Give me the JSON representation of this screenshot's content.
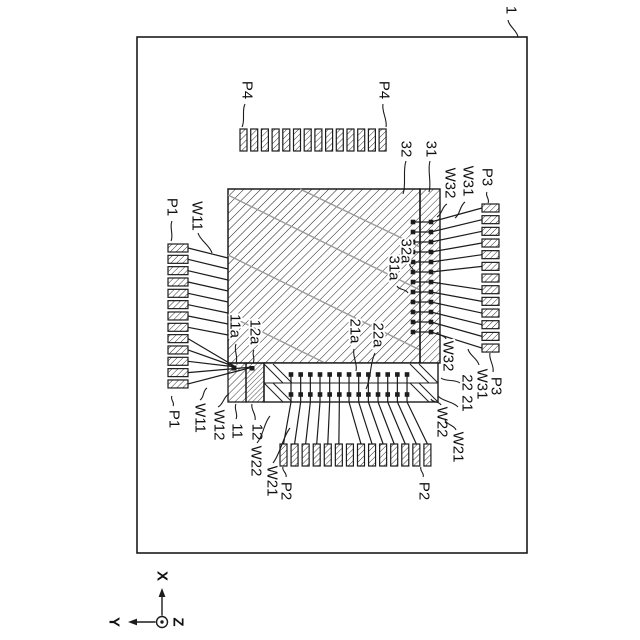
{
  "canvas": {
    "w": 640,
    "h": 640,
    "bg": "#ffffff"
  },
  "colors": {
    "line": "#1c1c1c",
    "gray": "#9b9b9b",
    "text": "#111111",
    "halo": "#ffffff"
  },
  "board": {
    "x": 137,
    "y": 37,
    "w": 390,
    "h": 516
  },
  "chip": {
    "x": 228,
    "y": 189,
    "w": 192,
    "h": 174,
    "gray_lines": [
      [
        228,
        195,
        420,
        290
      ],
      [
        228,
        255,
        420,
        350
      ],
      [
        228,
        315,
        325,
        363
      ],
      [
        300,
        189,
        420,
        247
      ]
    ]
  },
  "strip": {
    "x": 420,
    "y": 189,
    "w": 20,
    "h": 174
  },
  "bottom_strip": {
    "x": 228,
    "top": 363,
    "right": 438,
    "bottom": 402,
    "divider_y": 383,
    "cell11_x": 228,
    "cell12_x": 246,
    "cell_w": 18,
    "main_x": 264,
    "marks": [
      [
        234,
        366
      ],
      [
        252,
        366
      ]
    ],
    "decor": [
      [
        264,
        364,
        283,
        383
      ],
      [
        273,
        364,
        292,
        383
      ],
      [
        264,
        383,
        283,
        402
      ],
      [
        273,
        383,
        292,
        402
      ],
      [
        410,
        364,
        429,
        383
      ],
      [
        419,
        364,
        438,
        383
      ],
      [
        410,
        383,
        429,
        402
      ],
      [
        419,
        383,
        438,
        402
      ]
    ]
  },
  "pads": {
    "p4": {
      "count": 14,
      "x0": 240,
      "pitch": 10.7,
      "w": 7,
      "y": 129,
      "h": 22
    },
    "p1": {
      "count": 13,
      "y0": 244,
      "pitch": 11.33,
      "h": 8,
      "x": 168,
      "w": 20
    },
    "p3": {
      "count": 13,
      "y0": 204,
      "pitch": 11.67,
      "h": 8,
      "x": 482,
      "w": 17
    },
    "p2": {
      "count": 14,
      "x0": 280,
      "pitch": 11.07,
      "w": 7,
      "y": 444,
      "h": 22
    }
  },
  "dots": {
    "bottom": {
      "count": 13,
      "x0": 291,
      "pitch": 9.67,
      "row1": 374.5,
      "row2": 394.5,
      "size": 4.6,
      "strip_bottom": 402,
      "pad_top": 444,
      "pad_cx0": 283.5,
      "pad_pitch": 11.07,
      "skip_from": 6
    },
    "right": {
      "count": 12,
      "y0": 222,
      "pitch": 10,
      "col1": 413,
      "col2": 431,
      "size": 4.6,
      "pad_x": 482,
      "pad_cy0": 208,
      "pad_pitch": 11.67,
      "skip_from": 6
    }
  },
  "left_wires": {
    "pad_x": 188,
    "edge_x": 228,
    "edge_y0": 258,
    "edge_pitch": 11,
    "to_edge_count": 8,
    "cell11_target": [
      236,
      367
    ],
    "cell12_target": [
      253,
      367
    ],
    "cell11_wire_count": 3
  },
  "labels": [
    {
      "t": "1",
      "x": 511,
      "y": 10,
      "lead": [
        [
          508,
          20,
          518,
          37
        ]
      ]
    },
    {
      "t": "P4",
      "x": 247,
      "y": 90,
      "lead": [
        [
          245,
          104,
          242,
          127
        ]
      ]
    },
    {
      "t": "P4",
      "x": 384,
      "y": 90,
      "lead": [
        [
          383,
          104,
          386,
          127
        ]
      ]
    },
    {
      "t": "P1",
      "x": 172,
      "y": 207,
      "lead": [
        [
          172,
          221,
          171,
          241
        ]
      ]
    },
    {
      "t": "W11",
      "x": 197,
      "y": 216,
      "lead": [
        [
          198,
          233,
          212,
          253
        ]
      ]
    },
    {
      "t": "32",
      "x": 406,
      "y": 149,
      "lead": [
        [
          406,
          161,
          403,
          194
        ]
      ]
    },
    {
      "t": "31",
      "x": 431,
      "y": 149,
      "lead": [
        [
          430,
          161,
          429,
          192
        ]
      ]
    },
    {
      "t": "W32",
      "x": 450,
      "y": 183,
      "lead": [
        [
          447,
          204,
          437,
          217
        ]
      ]
    },
    {
      "t": "W31",
      "x": 468,
      "y": 181,
      "lead": [
        [
          465,
          202,
          455,
          218
        ]
      ]
    },
    {
      "t": "P3",
      "x": 487,
      "y": 177,
      "lead": [
        [
          487,
          192,
          488,
          203
        ]
      ]
    },
    {
      "t": "11a",
      "x": 235,
      "y": 326,
      "lead": [
        [
          236,
          344,
          236,
          363
        ]
      ]
    },
    {
      "t": "12a",
      "x": 255,
      "y": 332,
      "lead": [
        [
          254,
          350,
          253,
          363
        ]
      ]
    },
    {
      "t": "21a",
      "x": 355,
      "y": 331,
      "lead": [
        [
          354,
          349,
          356,
          371
        ]
      ]
    },
    {
      "t": "22a",
      "x": 378,
      "y": 335,
      "lead": [
        [
          375,
          353,
          366,
          389
        ]
      ]
    },
    {
      "t": "31a",
      "x": 394,
      "y": 268,
      "lead": [
        [
          397,
          286,
          408,
          293
        ]
      ]
    },
    {
      "t": "32a",
      "x": 406,
      "y": 251,
      "lead": [
        [
          410,
          264,
          413,
          271
        ]
      ]
    },
    {
      "t": "P1",
      "x": 174,
      "y": 419,
      "lead": [
        [
          173,
          406,
          172,
          396
        ]
      ]
    },
    {
      "t": "W11",
      "x": 200,
      "y": 418,
      "lead": [
        [
          200,
          400,
          207,
          388
        ]
      ]
    },
    {
      "t": "W12",
      "x": 219,
      "y": 425,
      "lead": [
        [
          218,
          407,
          229,
          394
        ]
      ]
    },
    {
      "t": "11",
      "x": 237,
      "y": 431,
      "lead": [
        [
          236,
          419,
          236,
          404
        ]
      ]
    },
    {
      "t": "12",
      "x": 257,
      "y": 432,
      "lead": [
        [
          255,
          420,
          252,
          404
        ]
      ]
    },
    {
      "t": "W22",
      "x": 256,
      "y": 461,
      "lead": [
        [
          257,
          443,
          270,
          416
        ]
      ]
    },
    {
      "t": "W21",
      "x": 272,
      "y": 481,
      "lead": [
        [
          273,
          463,
          290,
          428
        ]
      ]
    },
    {
      "t": "P2",
      "x": 286,
      "y": 491,
      "lead": [
        [
          286,
          477,
          283,
          467
        ]
      ]
    },
    {
      "t": "P2",
      "x": 424,
      "y": 491,
      "lead": [
        [
          423,
          477,
          421,
          467
        ]
      ]
    },
    {
      "t": "W22",
      "x": 442,
      "y": 422,
      "lead": [
        [
          441,
          405,
          431,
          399
        ]
      ]
    },
    {
      "t": "W21",
      "x": 458,
      "y": 447,
      "lead": [
        [
          456,
          430,
          445,
          420
        ]
      ]
    },
    {
      "t": "W32",
      "x": 448,
      "y": 356,
      "lead": [
        [
          446,
          339,
          437,
          332
        ]
      ]
    },
    {
      "t": "22 21",
      "x": 467,
      "y": 393,
      "lead": [
        [
          460,
          383,
          441,
          378
        ],
        [
          458,
          407,
          438,
          396
        ]
      ]
    },
    {
      "t": "W31",
      "x": 482,
      "y": 384,
      "lead": [
        [
          479,
          365,
          468,
          349
        ]
      ]
    },
    {
      "t": "P3",
      "x": 496,
      "y": 386,
      "lead": [
        [
          493,
          372,
          490,
          353
        ]
      ]
    }
  ],
  "axes": {
    "cx": 162,
    "cy": 622,
    "r": 5.5,
    "dot_r": 1.7,
    "x_arrow_tip": 588,
    "y_arrow_tip": 128,
    "x_label": "X",
    "y_label": "Y",
    "z_label": "Z",
    "x_label_pos": [
      162,
      576
    ],
    "y_label_pos": [
      114,
      622
    ],
    "z_label_pos": [
      178,
      622
    ]
  }
}
